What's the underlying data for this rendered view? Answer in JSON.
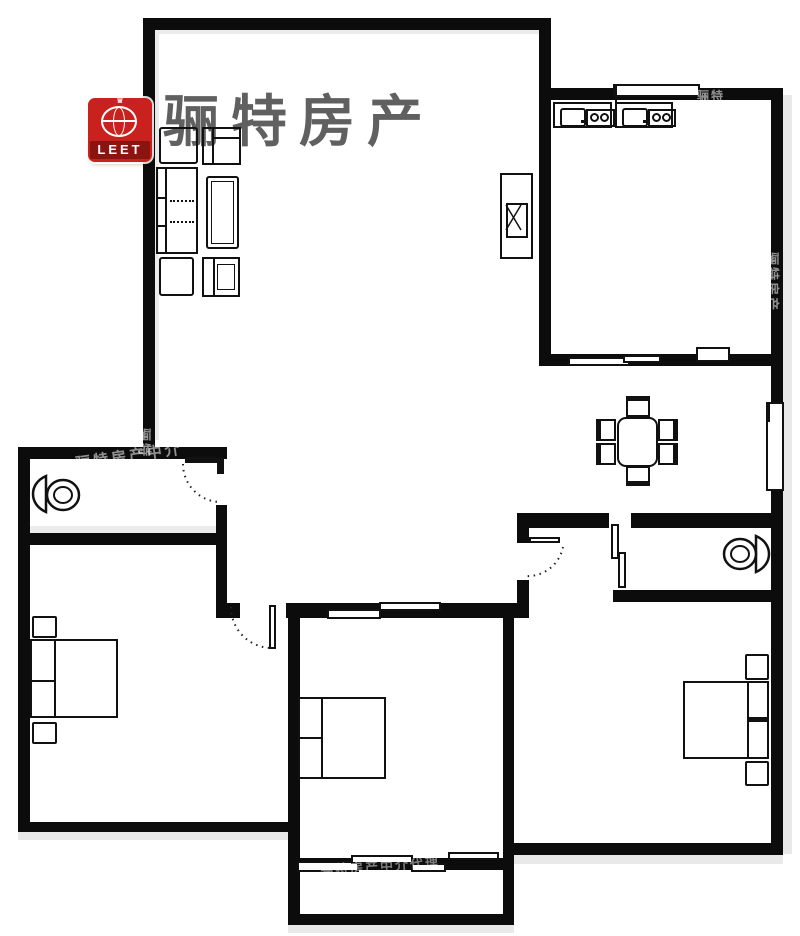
{
  "brand": {
    "name": "骊特房产",
    "color": "#444444"
  },
  "logo": {
    "text": "LEET",
    "bg_color": "#c9211e",
    "band_color": "#8a1410"
  },
  "watermark": {
    "text1": "骊特房产中介",
    "text2": "骊特房产",
    "text3": "骊特房产中介代理",
    "text4": "骊特",
    "text5": "骊特"
  },
  "palette": {
    "wall": "#0c0c0c",
    "floor": "#ffffff",
    "line": "#111111",
    "shadow": "#e9e9e9"
  }
}
